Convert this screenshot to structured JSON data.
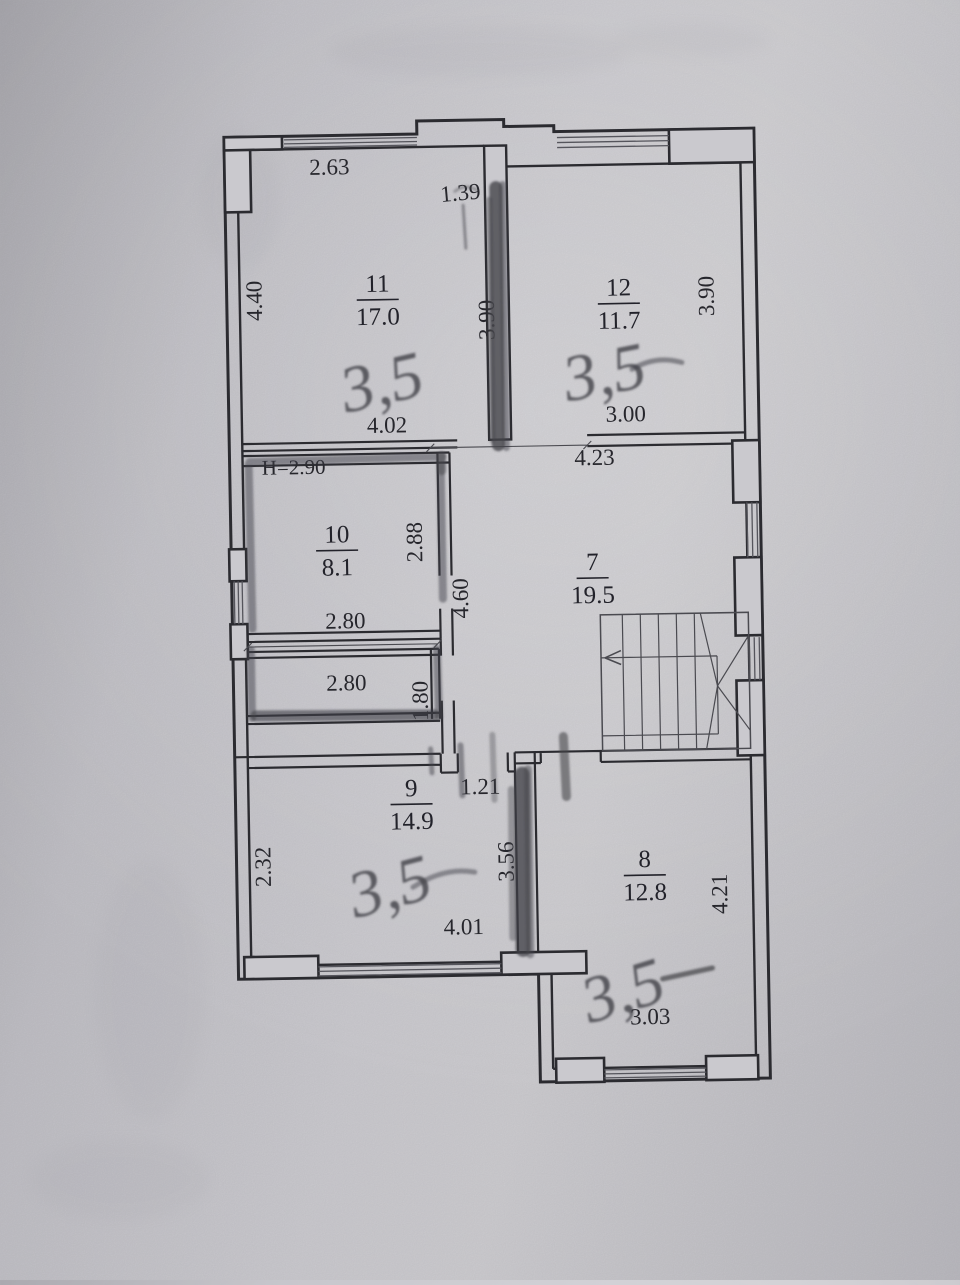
{
  "rooms": {
    "r11": {
      "number": "11",
      "area": "17.0"
    },
    "r12": {
      "number": "12",
      "area": "11.7"
    },
    "r10": {
      "number": "10",
      "area": "8.1"
    },
    "r7": {
      "number": "7",
      "area": "19.5"
    },
    "r9": {
      "number": "9",
      "area": "14.9"
    },
    "r8": {
      "number": "8",
      "area": "12.8"
    }
  },
  "dimensions": {
    "room11_top_width": "2.63",
    "top_niche_width": "1.39",
    "room11_left_height": "4.40",
    "room11_right_height": "3.90",
    "room11_bottom_width": "4.02",
    "room12_right_height": "3.90",
    "room12_bottom_width": "3.00",
    "hall_top_width": "4.23",
    "ceiling_height_note": "H=2.90",
    "room10_right_height": "2.88",
    "room10_bottom_width": "2.80",
    "closet_width": "2.80",
    "closet_height": "1.80",
    "hall_height": "4.60",
    "hall_ledge_width": "1.21",
    "room9_left_height": "2.32",
    "room9_right_height": "3.56",
    "room9_bottom_width": "4.01",
    "room8_right_height": "4.21",
    "room8_bottom_width": "3.03"
  },
  "pencil_annotations": {
    "room11": "3,5",
    "room12": "3,5",
    "room9": "3,5",
    "room8": "3,5"
  }
}
